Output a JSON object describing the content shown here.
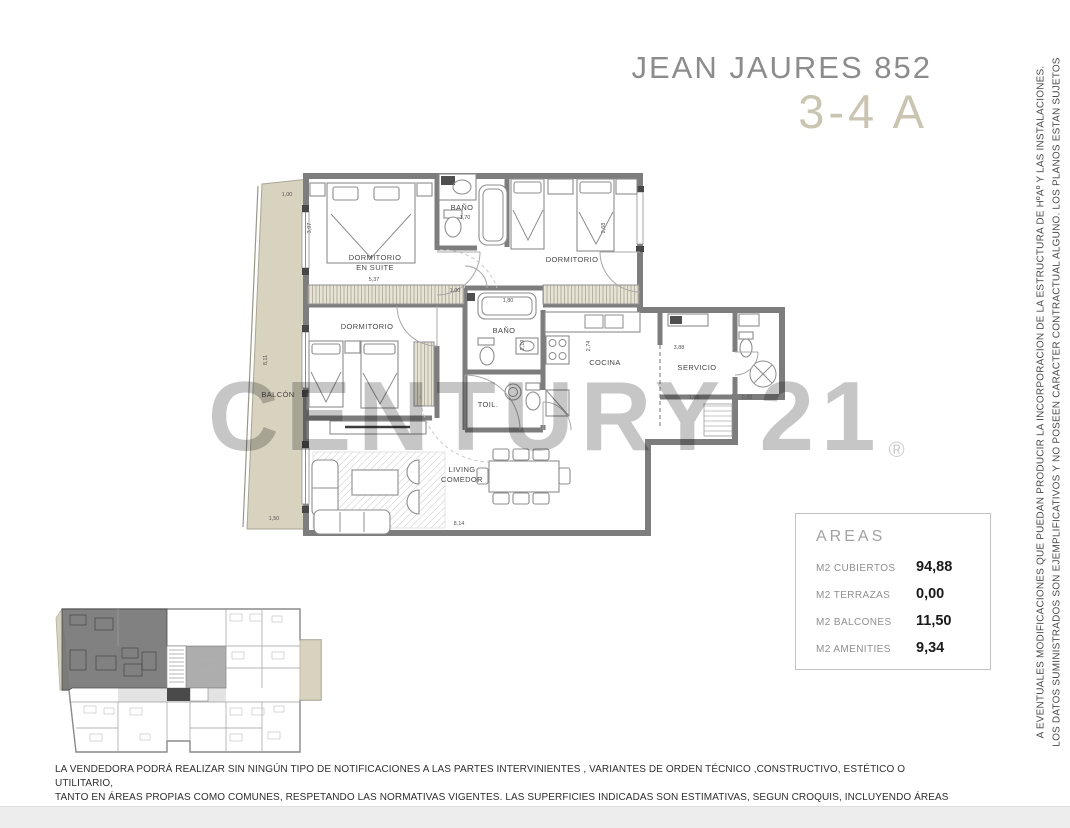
{
  "header": {
    "title": "JEAN JAURES 852",
    "unit": "3-4 A"
  },
  "watermark": {
    "text": "CENTURY 21",
    "registered": "®"
  },
  "plan": {
    "room_labels": {
      "dormitorio_en_suite_line1": "DORMITORIO",
      "dormitorio_en_suite_line2": "EN SUITE",
      "bano_principal": "BAÑO",
      "dormitorio_2": "DORMITORIO",
      "dormitorio_3": "DORMITORIO",
      "bano_2": "BAÑO",
      "toilette": "TOIL.",
      "cocina": "COCINA",
      "servicio": "SERVICIO",
      "living_line1": "LIVING",
      "living_line2": "COMEDOR",
      "balcon": "BALCÓN"
    },
    "dimensions": [
      "1,00",
      "3,97",
      "8,11",
      "1,50",
      "5,37",
      "1,00",
      "8,14",
      "2,68",
      "3,88",
      "1,85",
      "0,88",
      "1,80",
      "2,19",
      "2,74",
      "1,70"
    ]
  },
  "areas_panel": {
    "title": "AREAS",
    "rows": [
      {
        "label": "M2 CUBIERTOS",
        "value": "94,88"
      },
      {
        "label": "M2 TERRAZAS",
        "value": "0,00"
      },
      {
        "label": "M2 BALCONES",
        "value": "11,50"
      },
      {
        "label": "M2 AMENITIES",
        "value": "9,34"
      }
    ]
  },
  "side_disclaimer": {
    "line1": "LOS DATOS SUMINISTRADOS SON EJEMPLIFICATIVOS Y NO POSEEN CARACTER CONTRACTUAL ALGUNO. LOS PLANOS ESTAN SUJETOS",
    "line2": "A EVENTUALES MODIFICACIONES QUE PUEDAN PRODUCIR LA INCORPORACION DE LA ESTRUCTURA DE HºAº Y LAS INSTALACIONES."
  },
  "footer_disclaimer": {
    "line1": "LA VENDEDORA PODRÁ REALIZAR SIN NINGÚN TIPO DE NOTIFICACIONES A LAS PARTES INTERVINIENTES , VARIANTES DE ORDEN TÉCNICO ,CONSTRUCTIVO, ESTÉTICO O UTILITARIO,",
    "line2": "TANTO EN ÁREAS PROPIAS COMO COMUNES, RESPETANDO LAS NORMATIVAS VIGENTES. LAS SUPERFICIES INDICADAS SON ESTIMATIVAS, SEGUN CROQUIS, INCLUYENDO ÁREAS PROPIAS,",
    "line3": "BALCONES, TERRAZAS, DUCTOS, Y MUROS. LAS DIMENSIONES FINALES SURGIRÁN DEL REPLANTEO DE OBRA Y PLANO DE SUBDIVISIÓN."
  },
  "colors": {
    "title_gray": "#8c8c8c",
    "unit_tan": "#cac5b1",
    "wall_gray": "#7d7d7d",
    "balcony_fill": "#d8d3bf",
    "watermark_gray": "#c6c6c6",
    "highlight_unit_gray": "#6f6f6f"
  }
}
